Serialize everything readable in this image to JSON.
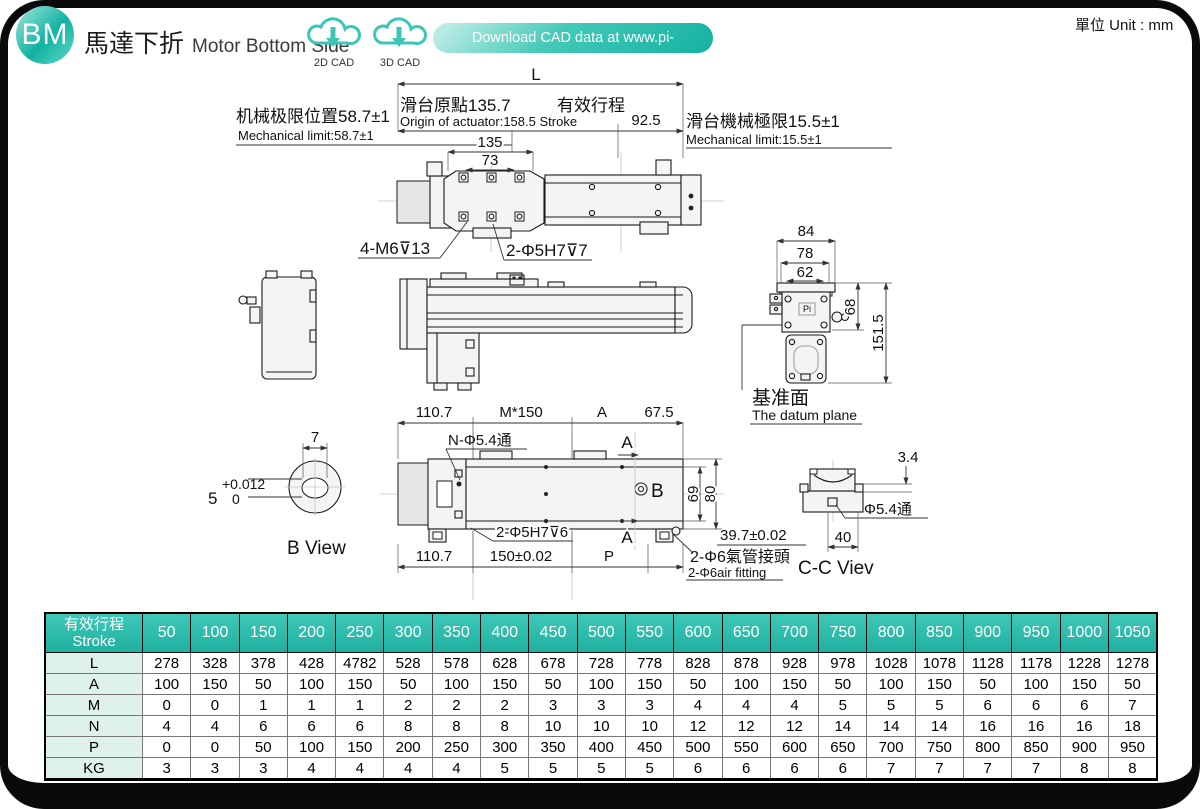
{
  "page": {
    "unit": "單位 Unit : mm"
  },
  "header": {
    "badge": "BM",
    "title_zh": "馬達下折",
    "title_en": "Motor Bottom Side",
    "cad2d": "2D CAD",
    "cad3d": "3D CAD",
    "download": "Download CAD data at www.pi-robot.com.cn"
  },
  "colors": {
    "teal": "#2dbcab",
    "table_header": "#2fbdac",
    "row_label_bg": "#def1ec",
    "gray_text": "#aeaeae"
  },
  "drawing": {
    "top": {
      "l": "L",
      "origin_zh": "滑台原點135.7",
      "stroke_zh": "有效行程",
      "origin_en": "Origin of actuator:158.5 Stroke",
      "d925": "92.5",
      "mech_left_zh": "机械极限位置58.7±1",
      "mech_left_en": "Mechanical limit:58.7±1",
      "mech_right_zh": "滑台機械極限15.5±1",
      "mech_right_en": "Mechanical limit:15.5±1",
      "d135": "135",
      "d73": "73",
      "m6": "4-M6⊽13",
      "phi5h7_7": "2-Φ5H7⊽7"
    },
    "section": {
      "d84": "84",
      "d78": "78",
      "d62": "62",
      "d68": "68",
      "d1515": "151.5",
      "logo": "Pi",
      "datum_zh": "基准面",
      "datum_en": "The datum plane"
    },
    "bottom": {
      "d1107t": "110.7",
      "m150": "M*150",
      "a_top": "A",
      "d675": "67.5",
      "nphi": "N-Φ5.4通",
      "a_mark_top": "A",
      "b_mark": "B",
      "d69": "69",
      "d80": "80",
      "phi5h7_6": "2-Φ5H7⊽6",
      "a_mark_bot": "A",
      "d1107b": "110.7",
      "d150": "150±0.02",
      "p": "P",
      "d397": "39.7±0.02",
      "air_zh": "2-Φ6氣管接頭",
      "air_en": "2-Φ6air fitting",
      "cc_label": "C-C Viev",
      "d34": "3.4",
      "phi54": "Φ5.4通",
      "d40": "40"
    },
    "bview": {
      "d7": "7",
      "tol_top": "+0.012",
      "tol_base": "5",
      "tol_bottom": "0",
      "label": "B View"
    }
  },
  "table": {
    "header_zh": "有效行程",
    "header_en": "Stroke",
    "strokes": [
      "50",
      "100",
      "150",
      "200",
      "250",
      "300",
      "350",
      "400",
      "450",
      "500",
      "550",
      "600",
      "650",
      "700",
      "750",
      "800",
      "850",
      "900",
      "950",
      "1000",
      "1050"
    ],
    "rows": [
      {
        "label": "L",
        "values": [
          "278",
          "328",
          "378",
          "428",
          "4782",
          "528",
          "578",
          "628",
          "678",
          "728",
          "778",
          "828",
          "878",
          "928",
          "978",
          "1028",
          "1078",
          "1128",
          "1178",
          "1228",
          "1278"
        ]
      },
      {
        "label": "A",
        "values": [
          "100",
          "150",
          "50",
          "100",
          "150",
          "50",
          "100",
          "150",
          "50",
          "100",
          "150",
          "50",
          "100",
          "150",
          "50",
          "100",
          "150",
          "50",
          "100",
          "150",
          "50"
        ]
      },
      {
        "label": "M",
        "values": [
          "0",
          "0",
          "1",
          "1",
          "1",
          "2",
          "2",
          "2",
          "3",
          "3",
          "3",
          "4",
          "4",
          "4",
          "5",
          "5",
          "5",
          "6",
          "6",
          "6",
          "7"
        ]
      },
      {
        "label": "N",
        "values": [
          "4",
          "4",
          "6",
          "6",
          "6",
          "8",
          "8",
          "8",
          "10",
          "10",
          "10",
          "12",
          "12",
          "12",
          "14",
          "14",
          "14",
          "16",
          "16",
          "16",
          "18"
        ]
      },
      {
        "label": "P",
        "values": [
          "0",
          "0",
          "50",
          "100",
          "150",
          "200",
          "250",
          "300",
          "350",
          "400",
          "450",
          "500",
          "550",
          "600",
          "650",
          "700",
          "750",
          "800",
          "850",
          "900",
          "950"
        ]
      },
      {
        "label": "KG",
        "values": [
          "3",
          "3",
          "3",
          "4",
          "4",
          "4",
          "4",
          "5",
          "5",
          "5",
          "5",
          "6",
          "6",
          "6",
          "6",
          "7",
          "7",
          "7",
          "7",
          "8",
          "8"
        ]
      }
    ]
  }
}
